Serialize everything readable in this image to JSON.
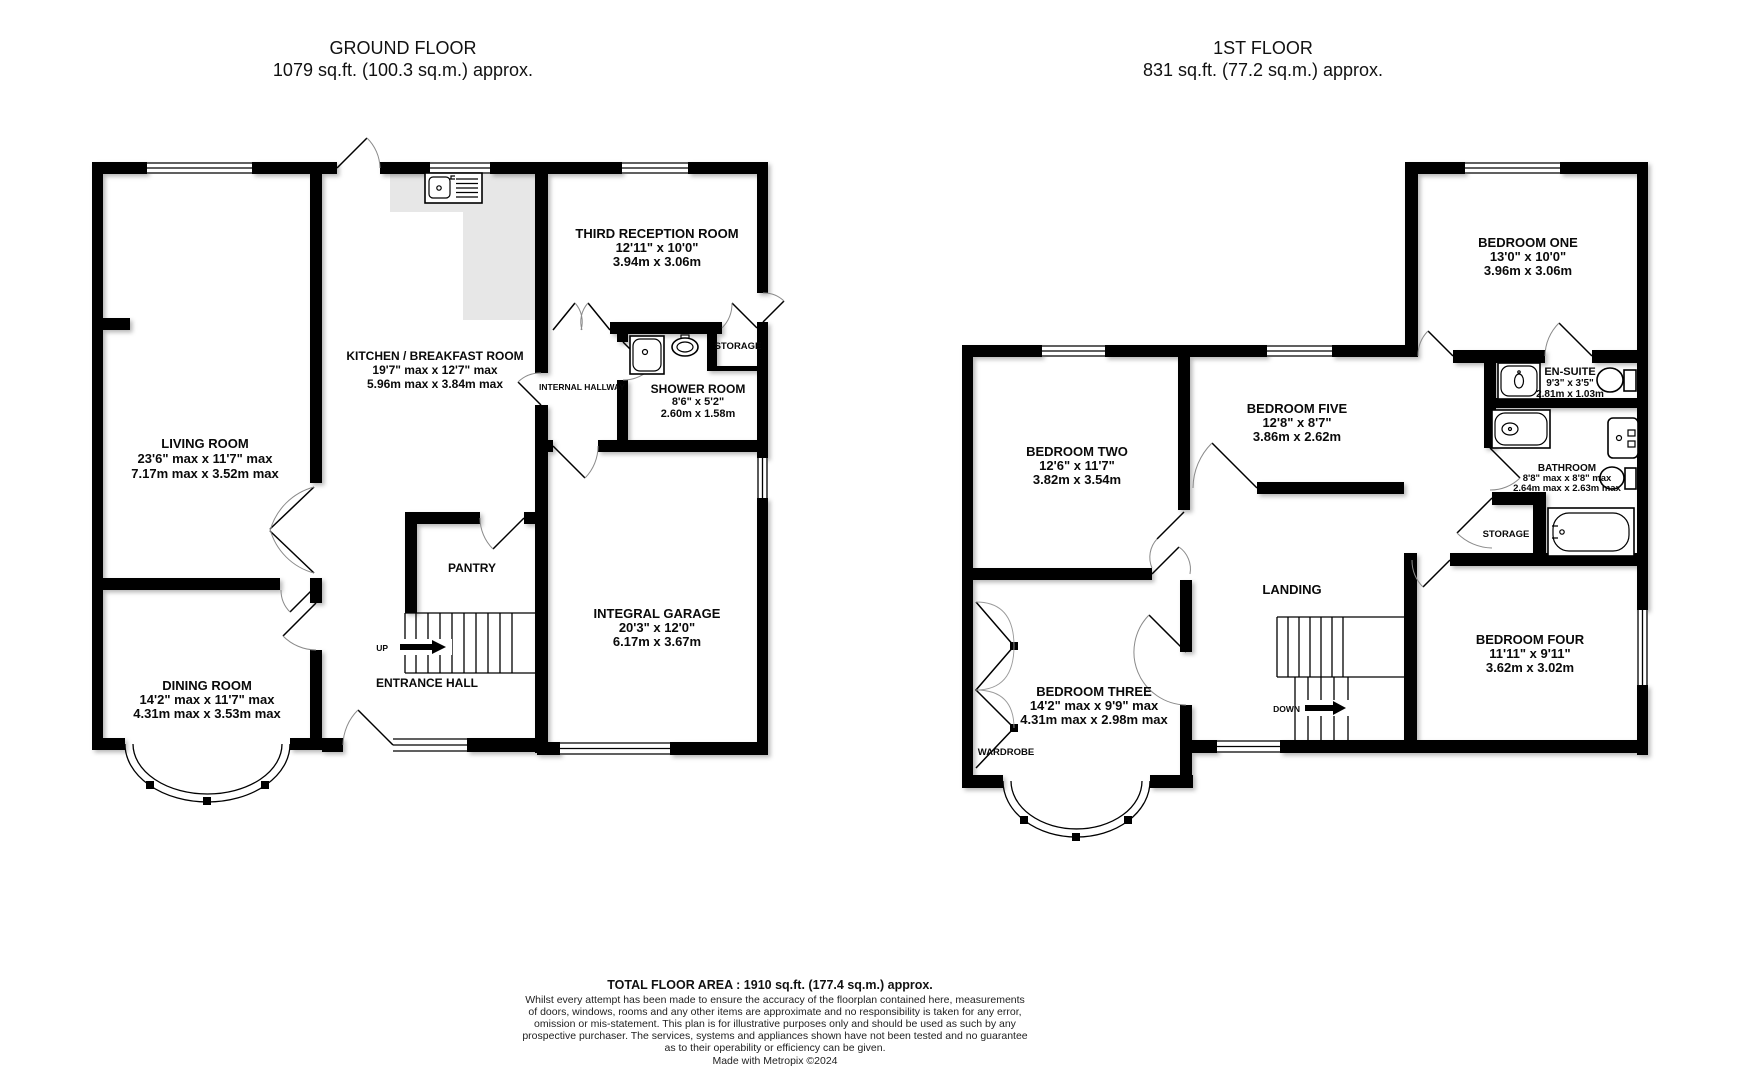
{
  "ground_floor": {
    "title": "GROUND FLOOR",
    "area": "1079 sq.ft. (100.3 sq.m.) approx.",
    "rooms": {
      "living": {
        "name": "LIVING ROOM",
        "imperial": "23'6\" max x 11'7\" max",
        "metric": "7.17m max x 3.52m max"
      },
      "kitchen": {
        "name": "KITCHEN / BREAKFAST ROOM",
        "imperial": "19'7\" max x 12'7\" max",
        "metric": "5.96m max x 3.84m max"
      },
      "reception": {
        "name": "THIRD RECEPTION ROOM",
        "imperial": "12'11\"  x 10'0\"",
        "metric": "3.94m  x 3.06m"
      },
      "shower": {
        "name": "SHOWER ROOM",
        "imperial": "8'6\"  x 5'2\"",
        "metric": "2.60m  x 1.58m"
      },
      "dining": {
        "name": "DINING ROOM",
        "imperial": "14'2\" max x 11'7\" max",
        "metric": "4.31m max x 3.53m max"
      },
      "garage": {
        "name": "INTEGRAL GARAGE",
        "imperial": "20'3\"  x 12'0\"",
        "metric": "6.17m  x 3.67m"
      }
    },
    "labels": {
      "pantry": "PANTRY",
      "entrance_hall": "ENTRANCE HALL",
      "internal_hallway": "INTERNAL HALLWAY",
      "storage": "STORAGE",
      "up": "UP"
    }
  },
  "first_floor": {
    "title": "1ST FLOOR",
    "area": "831 sq.ft. (77.2 sq.m.) approx.",
    "rooms": {
      "bedroom_one": {
        "name": "BEDROOM ONE",
        "imperial": "13'0\"  x 10'0\"",
        "metric": "3.96m  x 3.06m"
      },
      "bedroom_two": {
        "name": "BEDROOM TWO",
        "imperial": "12'6\"  x 11'7\"",
        "metric": "3.82m  x 3.54m"
      },
      "bedroom_three": {
        "name": "BEDROOM THREE",
        "imperial": "14'2\" max x 9'9\" max",
        "metric": "4.31m max x 2.98m max"
      },
      "bedroom_four": {
        "name": "BEDROOM FOUR",
        "imperial": "11'11\"  x 9'11\"",
        "metric": "3.62m  x 3.02m"
      },
      "bedroom_five": {
        "name": "BEDROOM FIVE",
        "imperial": "12'8\"  x 8'7\"",
        "metric": "3.86m  x 2.62m"
      },
      "ensuite": {
        "name": "EN-SUITE",
        "imperial": "9'3\"  x 3'5\"",
        "metric": "2.81m  x 1.03m"
      },
      "bathroom": {
        "name": "BATHROOM",
        "imperial": "8'8\" max x 8'8\" max",
        "metric": "2.64m max x 2.63m max"
      }
    },
    "labels": {
      "landing": "LANDING",
      "storage": "STORAGE",
      "wardrobe": "WARDROBE",
      "down": "DOWN"
    }
  },
  "footer": {
    "total_area": "TOTAL FLOOR AREA : 1910 sq.ft. (177.4 sq.m.) approx.",
    "disclaimer_lines": [
      "Whilst every attempt has been made to ensure the accuracy of the floorplan contained here, measurements",
      "of doors, windows, rooms and any other items are approximate and no responsibility is taken for any error,",
      "omission or mis-statement. This plan is for illustrative purposes only and should be used as such by any",
      "prospective purchaser. The services, systems and appliances shown have not been tested and no guarantee",
      "as to their operability or efficiency can be given."
    ],
    "credit": "Made with Metropix ©2024"
  },
  "colors": {
    "wall": "#000000",
    "counter": "#e7e7e7",
    "background": "#ffffff"
  }
}
